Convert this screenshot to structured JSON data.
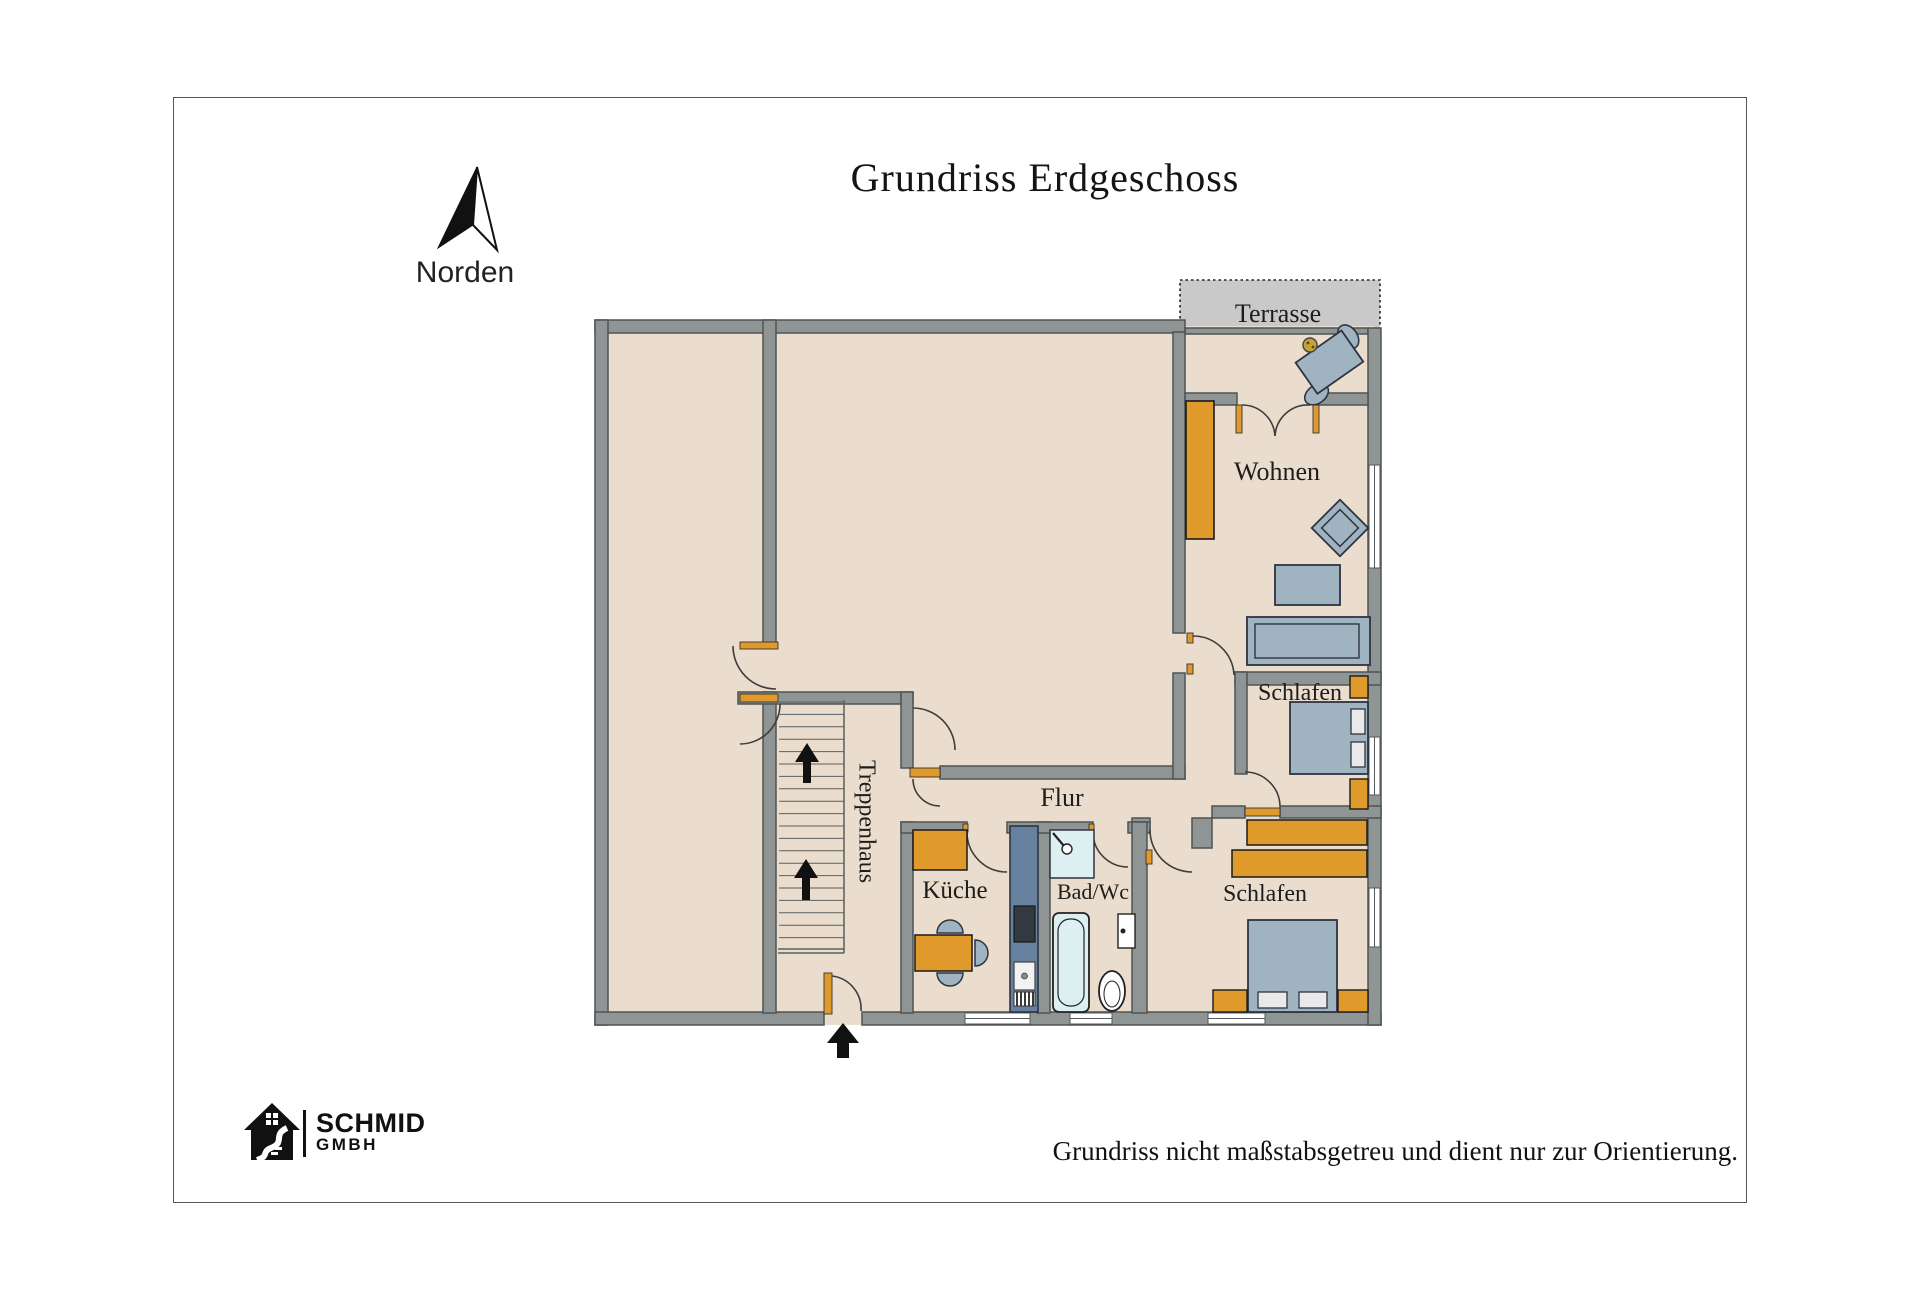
{
  "header": {
    "title": "Grundriss Erdgeschoss"
  },
  "compass": {
    "label": "Norden"
  },
  "rooms": {
    "terrasse": {
      "label": "Terrasse"
    },
    "wohnen": {
      "label": "Wohnen"
    },
    "schlafen_oben": {
      "label": "Schlafen"
    },
    "schlafen_unten": {
      "label": "Schlafen"
    },
    "flur": {
      "label": "Flur"
    },
    "kueche": {
      "label": "Küche"
    },
    "bad": {
      "label": "Bad/Wc"
    },
    "treppenhaus": {
      "label": "Treppenhaus"
    }
  },
  "footer": {
    "brand": "SCHMID",
    "brand_suffix": "GMBH",
    "disclaimer": "Grundriss nicht maßstabsgetreu und dient nur zur Orientierung."
  },
  "colors": {
    "floor": "#EBDDCD",
    "wall": "#8F9594",
    "wall_edge": "#4E5354",
    "accent_wood": "#E09A2C",
    "furniture_blue": "#9FB3C1",
    "bath_blue": "#DCF0F2",
    "counter_blue": "#66809F",
    "terrace_gray": "#C9C9C9"
  }
}
